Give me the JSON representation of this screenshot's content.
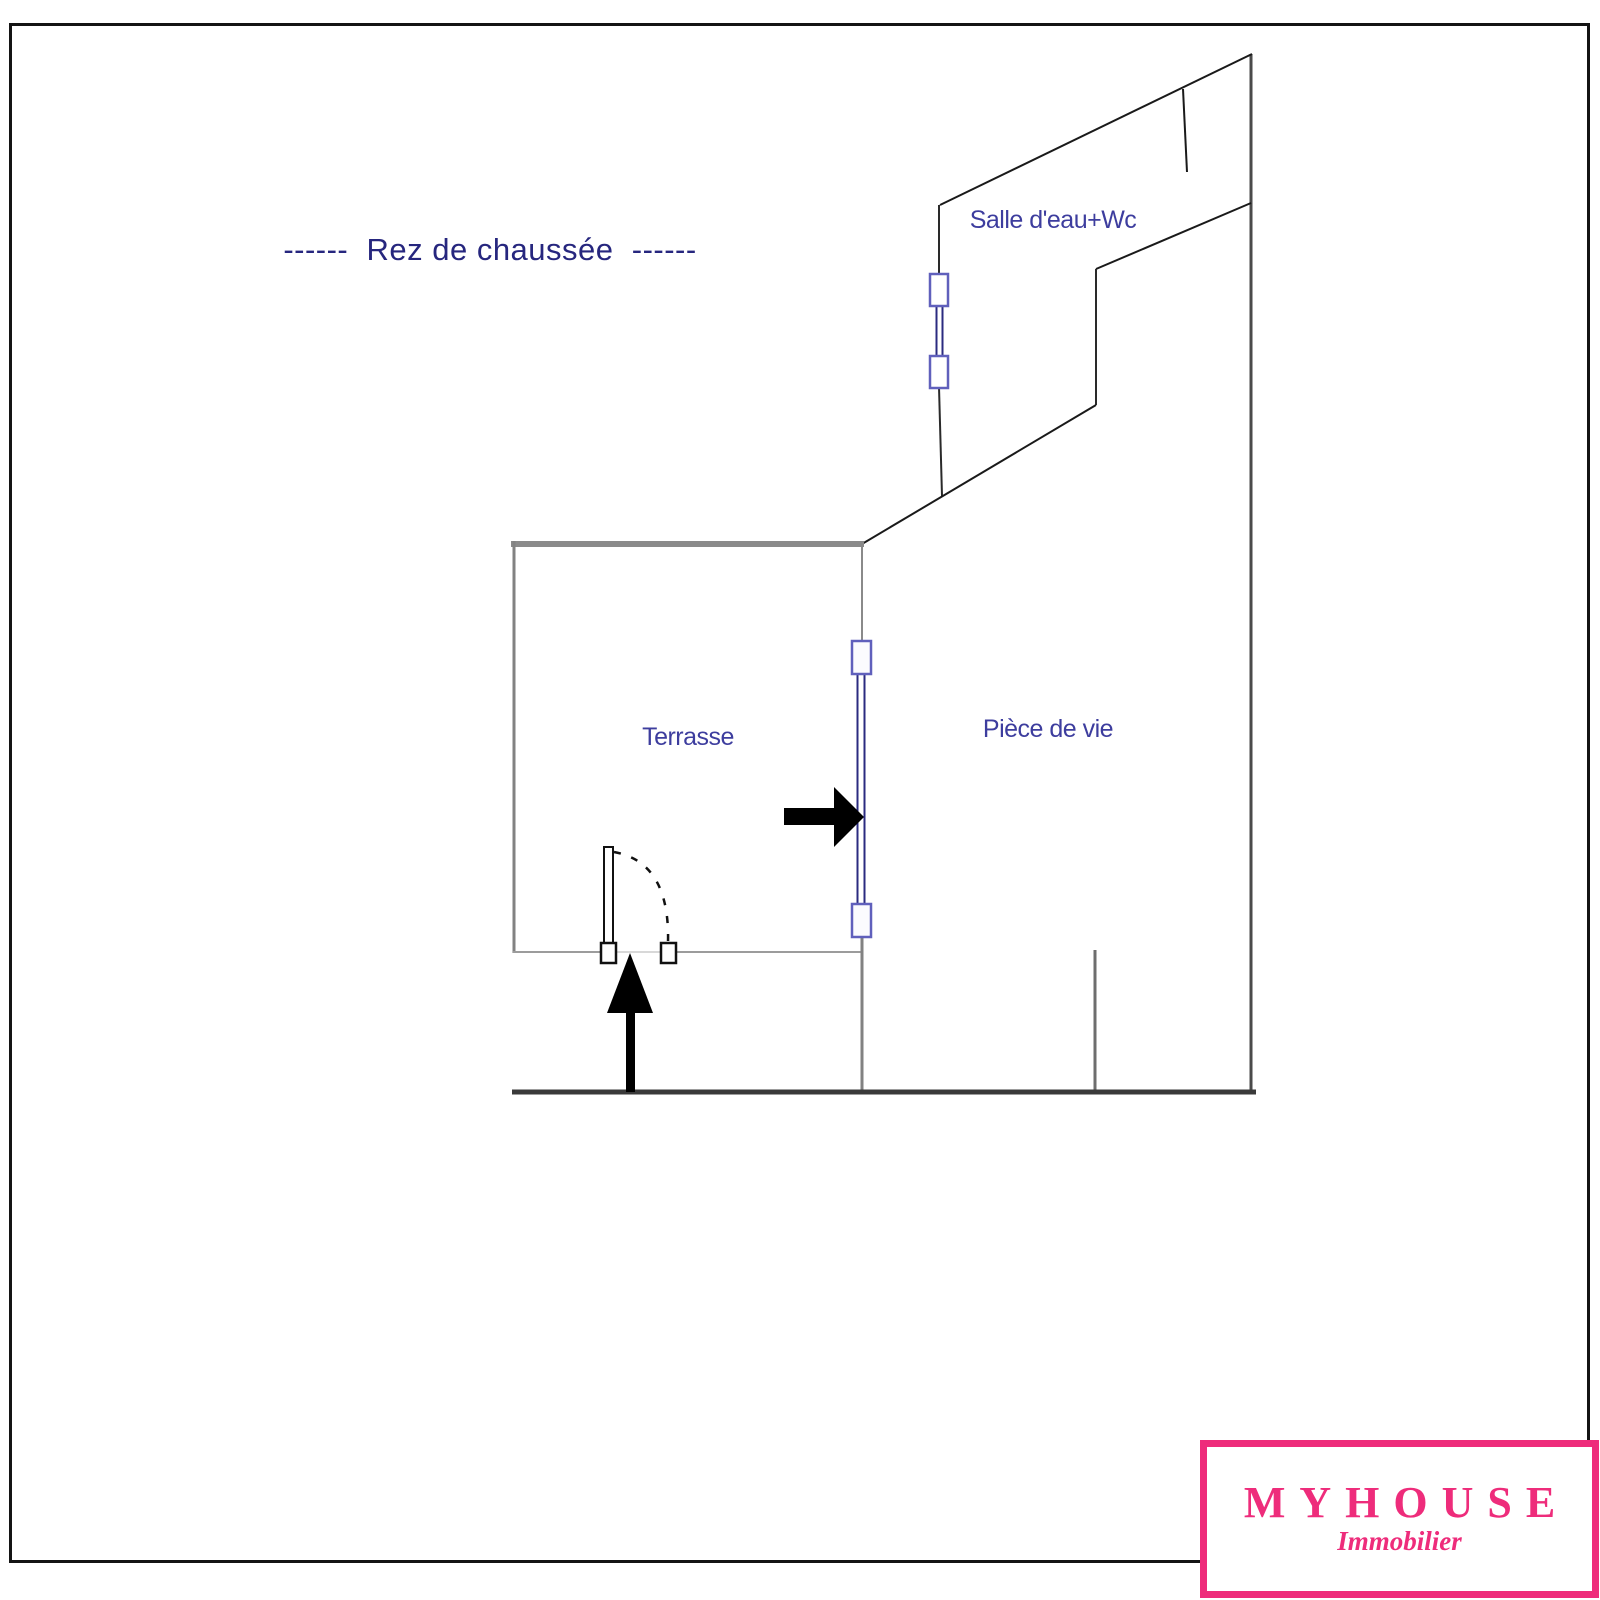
{
  "title": "------  Rez de chaussée  ------",
  "plan": {
    "rooms": [
      {
        "label": "Salle d'eau+Wc"
      },
      {
        "label": "Terrasse"
      },
      {
        "label": "Pièce de vie"
      }
    ]
  },
  "logo": {
    "name": "MYHOUSE",
    "tagline": "Immobilier"
  },
  "colors": {
    "title_navy": "#26267e",
    "room_label_blue": "#3d3d9e",
    "logo_pink": "#ee2c7b",
    "wall_gray": "#8a8a8a",
    "wall_black": "#1a1a1a",
    "window_purple": "#6060bc",
    "window_inner_navy": "#2b2b80"
  }
}
